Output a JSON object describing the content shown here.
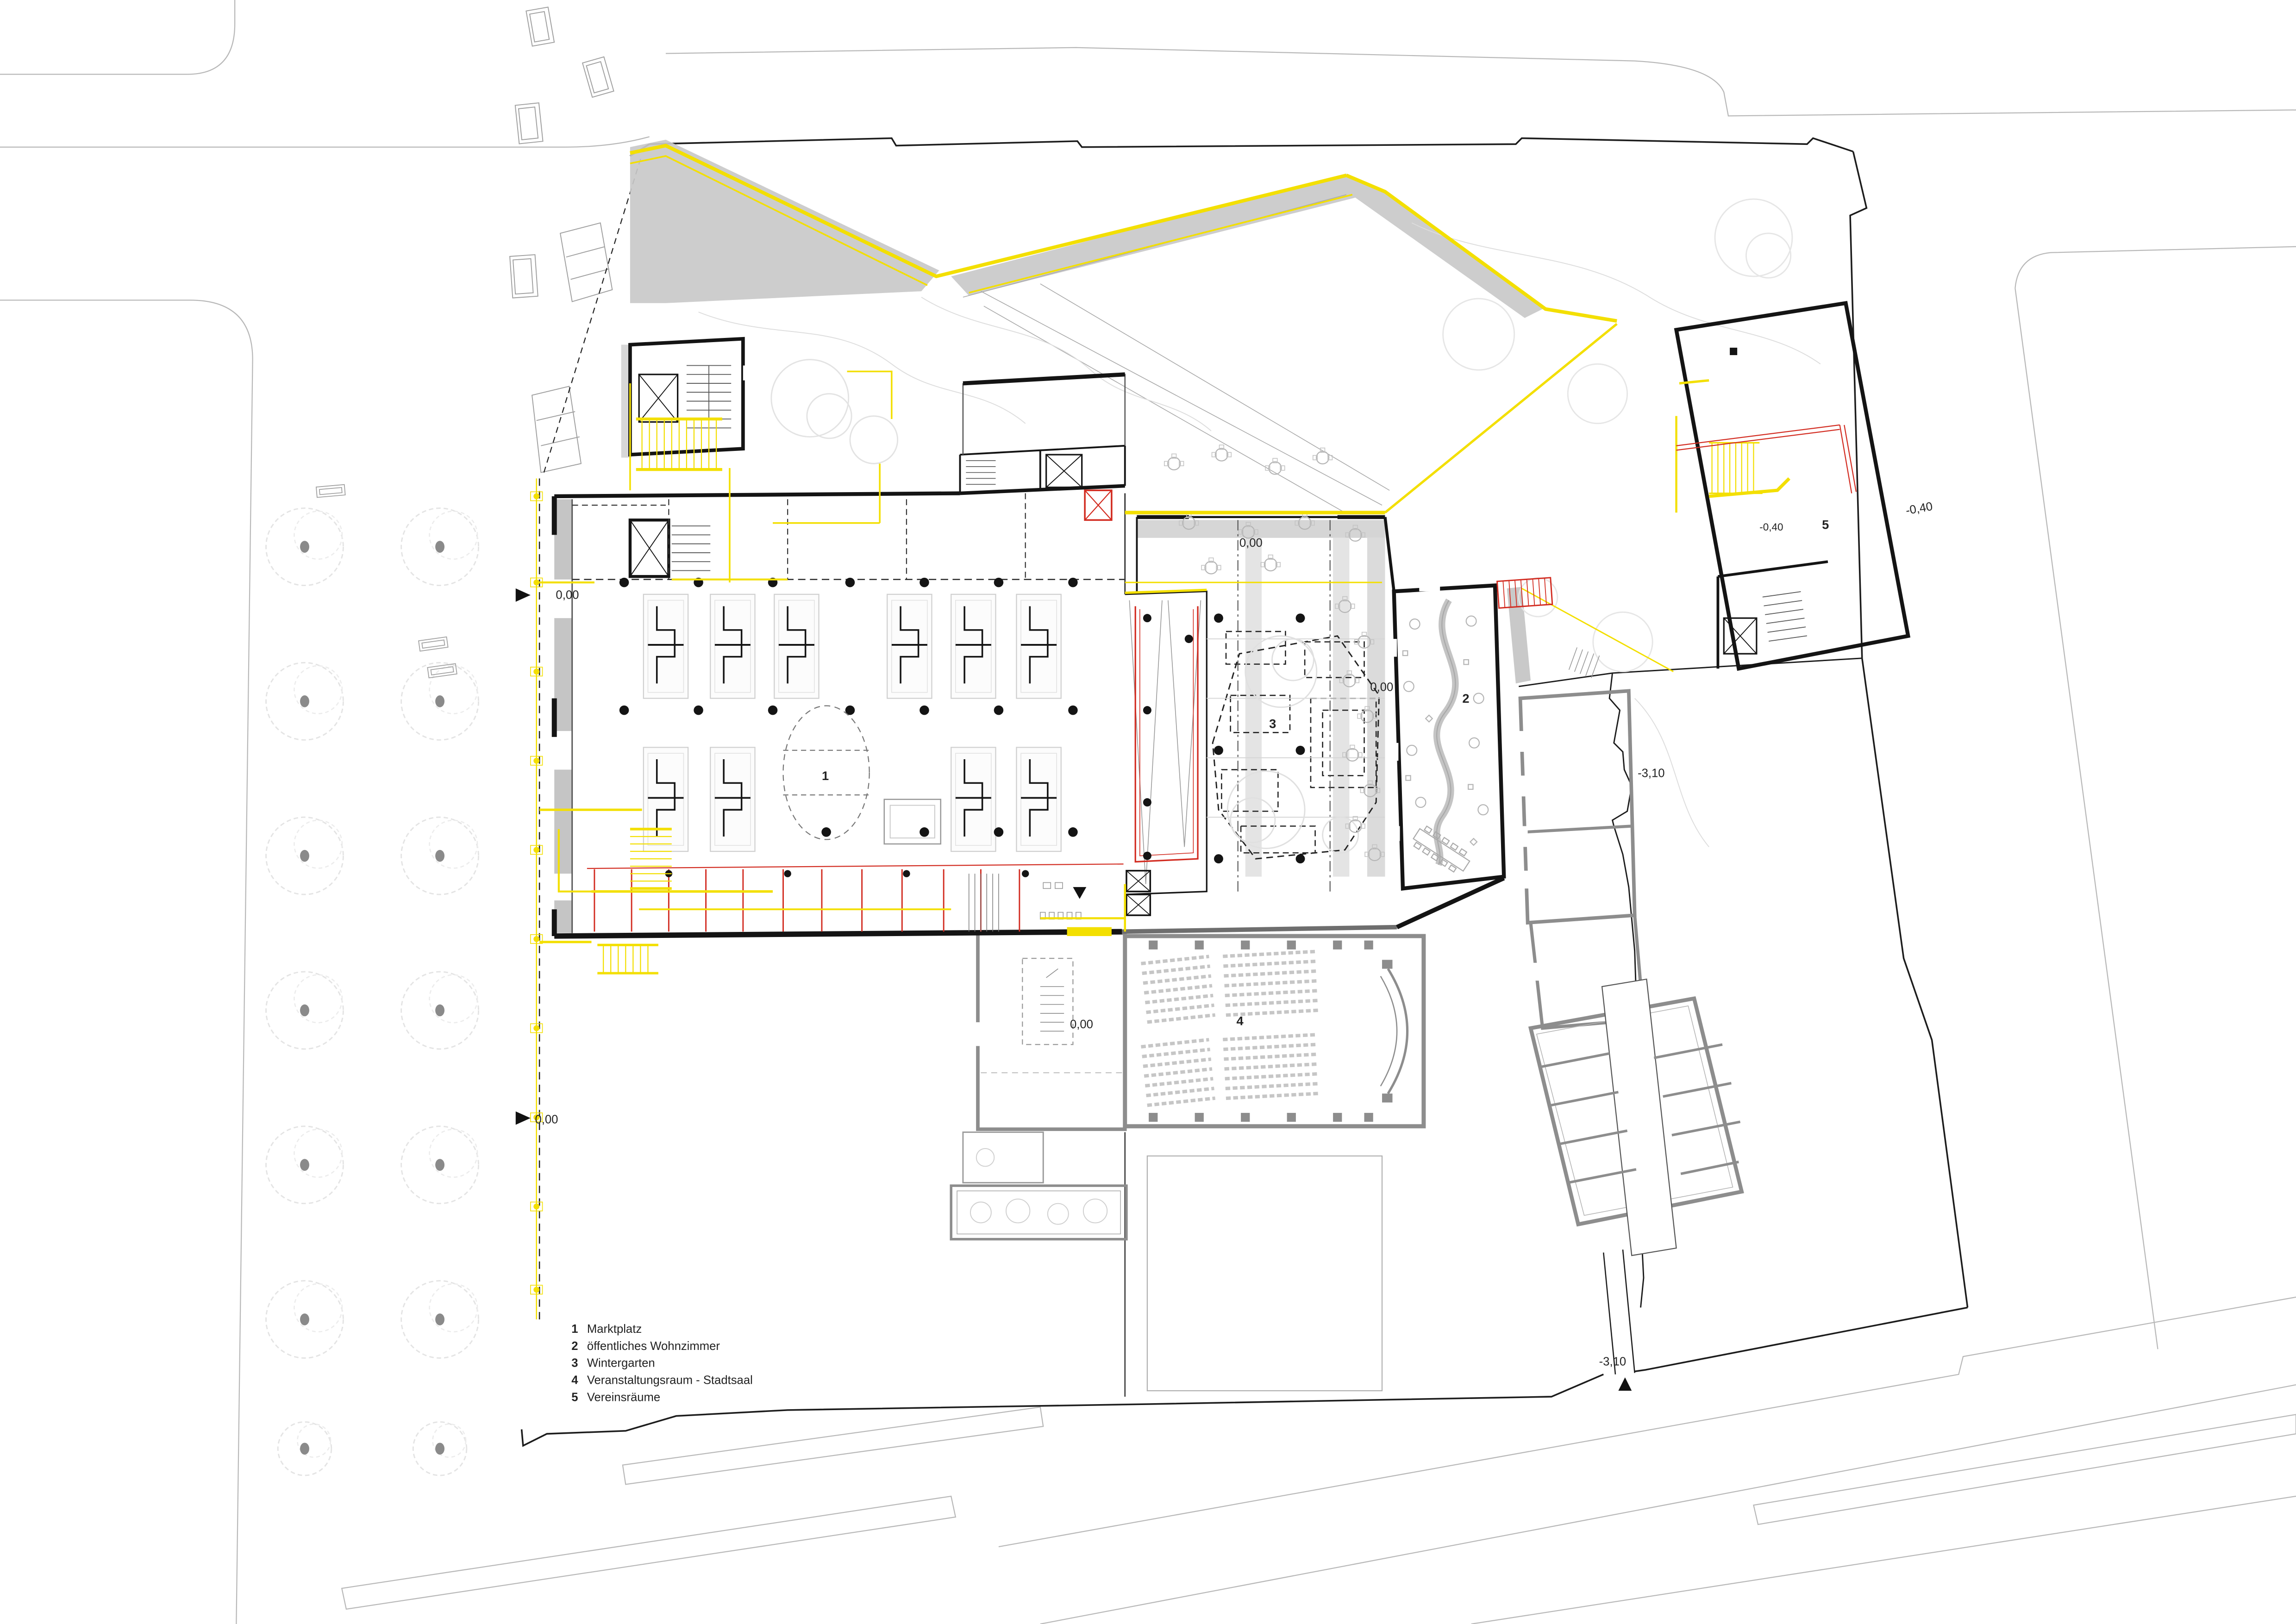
{
  "drawing": {
    "kind": "architectural ground floor site plan",
    "legend": {
      "items": [
        {
          "num": "1",
          "label": "Marktplatz"
        },
        {
          "num": "2",
          "label": "öffentliches Wohnzimmer"
        },
        {
          "num": "3",
          "label": "Wintergarten"
        },
        {
          "num": "4",
          "label": "Veranstaltungsraum - Stadtsaal"
        },
        {
          "num": "5",
          "label": "Vereinsräume"
        }
      ]
    },
    "room_numbers": {
      "marktplatz": "1",
      "wohnzimmer": "2",
      "wintergarten": "3",
      "stadtsaal": "4",
      "vereinsraeume": "5"
    },
    "levels": {
      "ground": "0,00",
      "minus040": "-0,40",
      "minus310": "-3,10"
    },
    "colors": {
      "highlight_yellow": "#f3df00",
      "accent_red": "#d22b20",
      "existing_gray": "#8d8d8d",
      "poche_gray": "#c9c9c9",
      "street_gray": "#b8b8b8",
      "line_black": "#1a1a1a"
    }
  }
}
